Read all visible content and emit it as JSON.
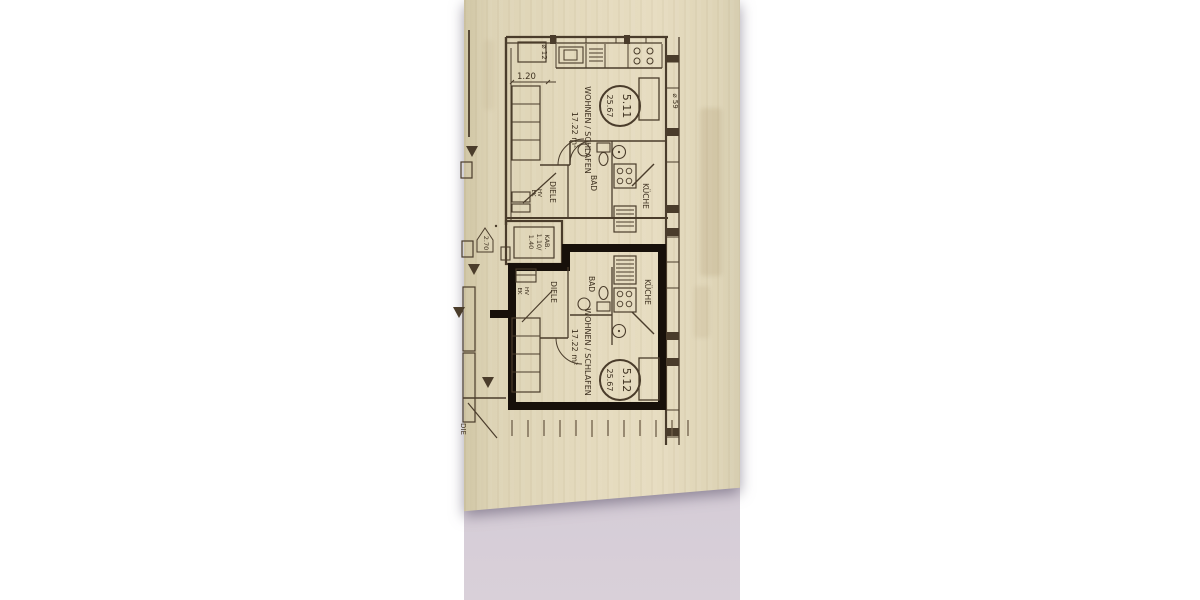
{
  "photo": {
    "paper_color": "#e4dabd",
    "surface_color": "#cdc6d1",
    "background_color": "#ffffff",
    "ink_color": "#4a3c2b",
    "marker_color": "#17100a"
  },
  "u511": {
    "number": "5.11",
    "area": "25.67",
    "living": "WOHNEN / SCHLAFEN",
    "living_area": "17.22 m²",
    "hall": "DIELE",
    "bath": "BAD",
    "kitchen": "KÜCHE",
    "hv": "HV",
    "ek": "EK"
  },
  "u512": {
    "number": "5.12",
    "area": "25.67",
    "living": "WOHNEN / SCHLAFEN",
    "living_area": "17.22 m²",
    "hall": "DIELE",
    "bath": "BAD",
    "kitchen": "KÜCHE",
    "hv": "HV",
    "ek": "EK"
  },
  "kab": {
    "name": "KAB.",
    "dim1": "1.10/",
    "dim2": "1.40"
  },
  "marks": {
    "dim": "1.20",
    "level": "2.70",
    "dia_top": "⌀ 12",
    "dia_right": "⌀ 59",
    "partial": "DIE"
  }
}
